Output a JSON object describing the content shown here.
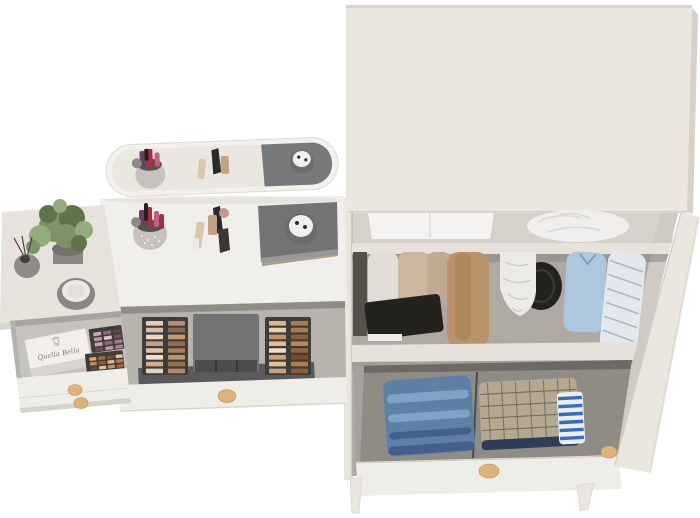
{
  "scene": {
    "description": "3D product render: white vanity dressing table with tilted mirror and open makeup drawers, side table with plant, and open wardrobe with clothes, folded jeans and an open bottom drawer",
    "background": "#ffffff"
  },
  "labels": {
    "box_brand": "Quella Bella"
  },
  "colors": {
    "background": "#ffffff",
    "body": "#eae6e0",
    "body_shade": "#d6d1ca",
    "front": "#efede8",
    "tabletop": "#e7e3dc",
    "mirror_frame": "#f3f1ed",
    "mirror_glass": "#eae7e1",
    "drawer_left_interior": "#c6c3be",
    "drawer_vanity_interior": "#b7b4ae",
    "wardrobe_back_top": "#d5d1cb",
    "wardrobe_back_mid": "#aeaaa3",
    "wardrobe_drawer_interior": "#8f8c86",
    "shelf": "#e6e2db",
    "case_gray": "#717375",
    "case_gray_dark": "#4b4c4d",
    "palette_frame": "#3d3d3c",
    "knob_wood": "#ddb27b",
    "pot_gray": "#8b8883",
    "plant_green": "#7d9367",
    "plant_green_dark": "#5f7549",
    "plant_green_light": "#94ac7d",
    "jeans": "#5d81a6",
    "jeans_light": "#7ea3c3",
    "jeans_dark": "#44608a",
    "plaid": "#b3a890",
    "plaid_line": "#6f6757",
    "navy": "#2e3d59",
    "stripe_blue": "#3a6db8",
    "shirt_blue": "#adc8de",
    "camel": "#b9946a",
    "white_soft": "#eceae6",
    "black_soft": "#24221f",
    "box_white": "#f1efec",
    "label_text": "#7b756d"
  },
  "makeup_kit": {
    "left": {
      "x": 146,
      "y": 321,
      "cols": 2,
      "rows": 8,
      "cw": 17,
      "ch": 4.6,
      "gx": 5,
      "gy": 2.2,
      "colors": [
        "#e3cdb4",
        "#b98f6d",
        "#d9bda1",
        "#8a6a52",
        "#e8d6bf",
        "#c89b72",
        "#c4a184",
        "#8f6c50",
        "#e2c3a4",
        "#aa7d5c",
        "#efe0cd",
        "#c2926b",
        "#d4ad8a",
        "#96704f",
        "#e6d2ba",
        "#b5876a"
      ]
    },
    "right": {
      "x": 269,
      "y": 321,
      "cols": 2,
      "rows": 8,
      "cw": 17,
      "ch": 4.6,
      "gx": 5,
      "gy": 2.2,
      "colors": [
        "#d9b596",
        "#a5795a",
        "#e6cdb0",
        "#b5764a",
        "#c99263",
        "#8a5f41",
        "#e3bd92",
        "#c08455",
        "#efdcc3",
        "#9a6238",
        "#d4a276",
        "#7a4a2a",
        "#e0c09c",
        "#b07c50",
        "#caa07a",
        "#8f5c35"
      ]
    }
  },
  "left_drawer_palettes": {
    "p1": {
      "x": 94,
      "y": 331,
      "cols": 3,
      "rows": 4,
      "cw": 8,
      "ch": 3.6,
      "gx": 2,
      "gy": 1.6,
      "colors": [
        "#c7a8b4",
        "#8a6a78",
        "#5f4350",
        "#b493a2",
        "#d9c2cc",
        "#74505f",
        "#c2a0ae",
        "#8f6b7a",
        "#a27f8e",
        "#6b4b58",
        "#ba97a5",
        "#a5818f"
      ]
    },
    "p2": {
      "x": 90,
      "y": 356,
      "cols": 4,
      "rows": 4,
      "cw": 7,
      "ch": 3.4,
      "gx": 1.8,
      "gy": 1.4,
      "colors": [
        "#d9a678",
        "#a56a3f",
        "#7a4a2a",
        "#e8c49a",
        "#c08455",
        "#8f5c35",
        "#dfb88c",
        "#b5764a",
        "#6e452a",
        "#e3bd92",
        "#c99263",
        "#9a6238",
        "#d4a276",
        "#b07c50",
        "#83522f",
        "#e0bb8e"
      ]
    }
  }
}
